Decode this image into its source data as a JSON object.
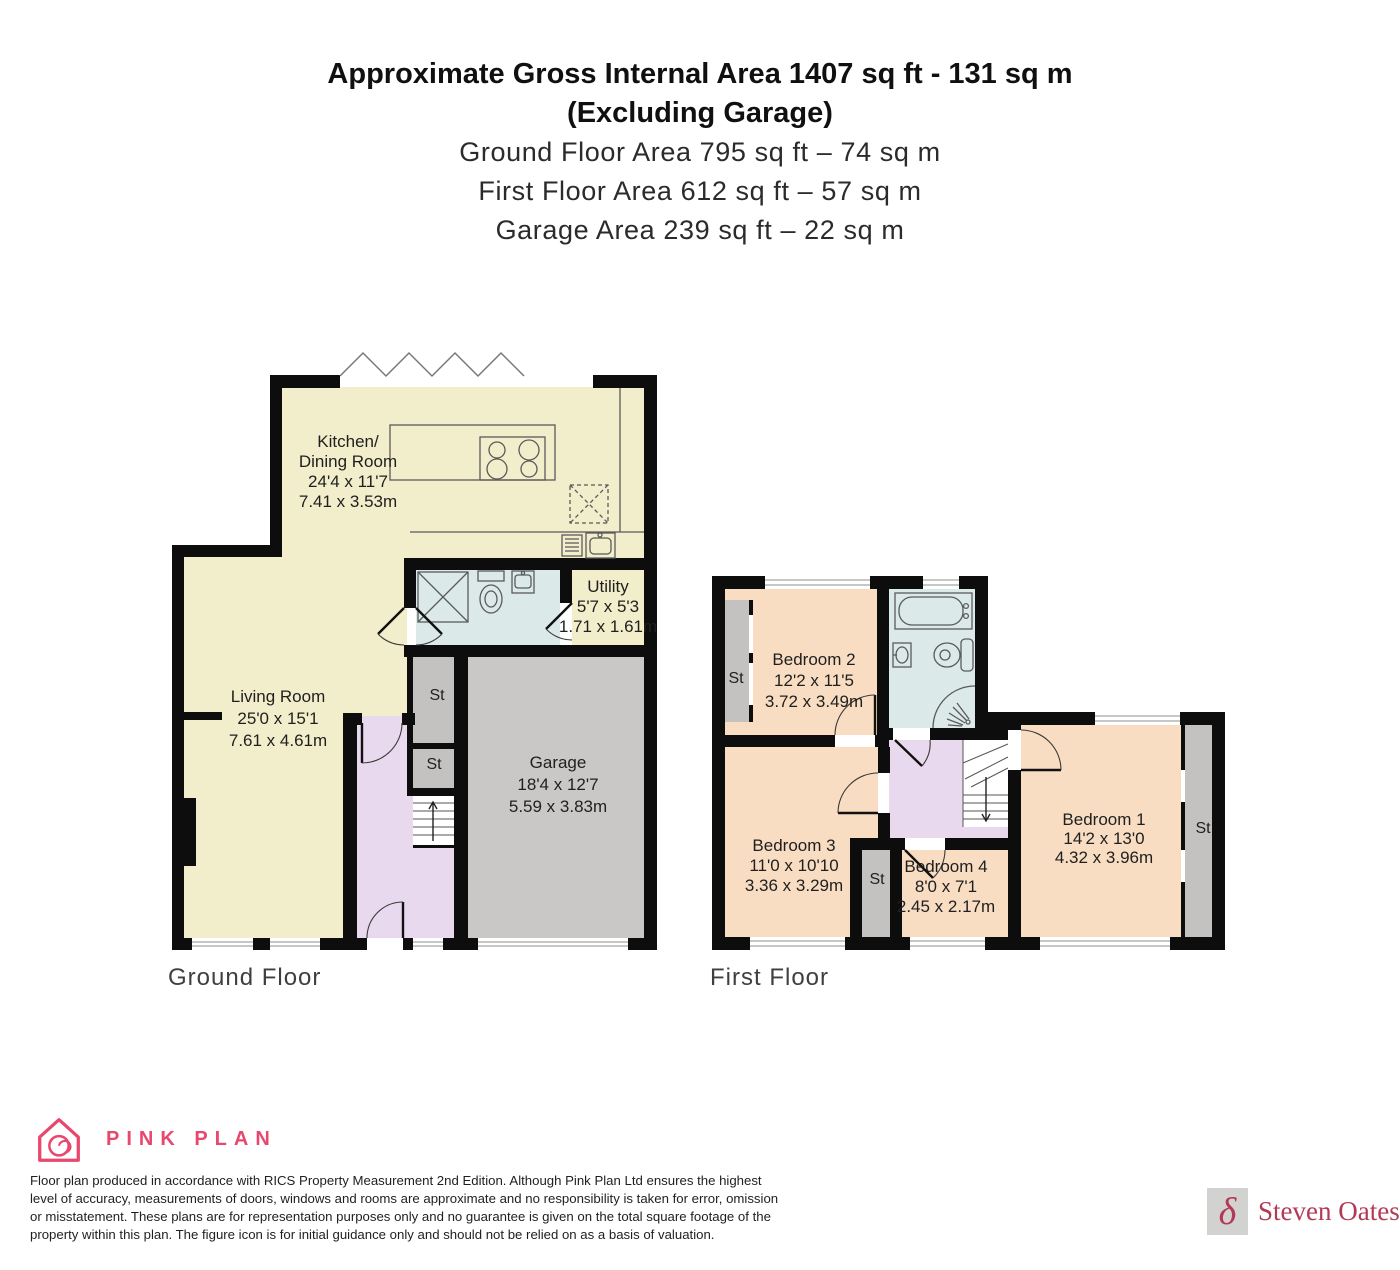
{
  "header": {
    "line1": "Approximate Gross Internal Area 1407 sq ft - 131 sq m",
    "line2": "(Excluding Garage)",
    "line3": "Ground Floor Area 795 sq ft – 74 sq m",
    "line4": "First Floor Area 612 sq ft – 57 sq m",
    "line5": "Garage Area 239 sq ft – 22 sq m"
  },
  "ground_floor": {
    "floor_label": "Ground Floor",
    "kitchen": {
      "name1": "Kitchen/",
      "name2": "Dining Room",
      "imperial": "24'4 x 11'7",
      "metric": "7.41 x 3.53m"
    },
    "living_room": {
      "name": "Living Room",
      "imperial": "25'0 x 15'1",
      "metric": "7.61 x 4.61m"
    },
    "utility": {
      "name": "Utility",
      "imperial": "5'7 x 5'3",
      "metric": "1.71 x 1.61m"
    },
    "garage": {
      "name": "Garage",
      "imperial": "18'4 x 12'7",
      "metric": "5.59 x 3.83m"
    },
    "storage1": "St",
    "storage2": "St"
  },
  "first_floor": {
    "floor_label": "First Floor",
    "bedroom1": {
      "name": "Bedroom 1",
      "imperial": "14'2 x 13'0",
      "metric": "4.32 x 3.96m"
    },
    "bedroom2": {
      "name": "Bedroom 2",
      "imperial": "12'2 x 11'5",
      "metric": "3.72 x 3.49m"
    },
    "bedroom3": {
      "name": "Bedroom 3",
      "imperial": "11'0 x 10'10",
      "metric": "3.36 x 3.29m"
    },
    "bedroom4": {
      "name": "Bedroom 4",
      "imperial": "8'0 x 7'1",
      "metric": "2.45 x 2.17m"
    },
    "storage_bedroom2": "St",
    "storage_bedroom34": "St",
    "storage_bedroom1": "St"
  },
  "footer": {
    "brand_name": "PINK PLAN",
    "disclaimer_line1": "Floor plan produced in accordance with RICS Property Measurement 2nd Edition. Although Pink Plan Ltd ensures the highest",
    "disclaimer_line2": "level of accuracy, measurements of doors, windows and rooms are approximate and no responsibility is taken for error, omission",
    "disclaimer_line3": "or misstatement. These plans are for representation purposes only and no guarantee is given on the total square footage of the",
    "disclaimer_line4": "property within this plan. The figure icon is for initial guidance only and should not be relied on as a basis of valuation.",
    "agent_name": "Steven Oates",
    "agent_symbol": "δ"
  },
  "colors": {
    "cream": "#f2edca",
    "peach": "#f8ddc2",
    "blue": "#dbe9e8",
    "purple": "#e9d9ee",
    "gray_room": "#c9c8c6",
    "gray_storage": "#c3c2c0",
    "wall": "#0d0d0d",
    "brand_pink": "#e8486e",
    "agent_crimson": "#b23a56"
  }
}
